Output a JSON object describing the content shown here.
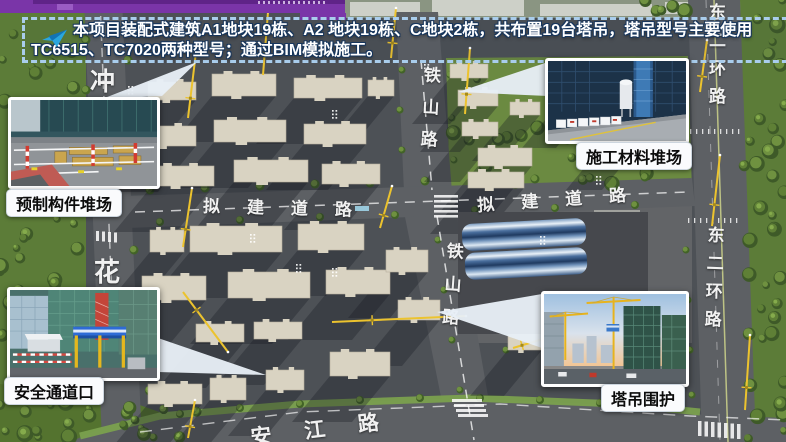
{
  "slide": {
    "banner": {
      "icon": "paper-plane-icon",
      "line1": "本项目装配式建筑A1地块19栋、A2 地块19栋、C地块2栋，共布置19台塔吊，塔吊型号主要使用",
      "line2": "TC6515、TC7020两种型号；通过BIM模拟施工。"
    },
    "callouts": {
      "precast_yard": {
        "label": "预制构件堆场"
      },
      "material_yard": {
        "label": "施工材料堆场"
      },
      "safety_entrance": {
        "label": "安全通道口"
      },
      "crane_enclosure": {
        "label": "塔吊围护"
      }
    },
    "roads": {
      "chong": "冲",
      "hua": "花",
      "tieshan_upper": "铁山路",
      "tieshan_lower": "铁山路",
      "planned_west": "拟建道路",
      "planned_east": "拟建道路",
      "ring_upper": "东二环路",
      "ring_lower": "东二环路",
      "anjiang": "安江路"
    },
    "colors": {
      "accent_purple": "#7a35a8",
      "banner_border": "#a9cdec",
      "crane_yellow": "#ecc32e",
      "callout_bg": "#fafbfd"
    }
  }
}
